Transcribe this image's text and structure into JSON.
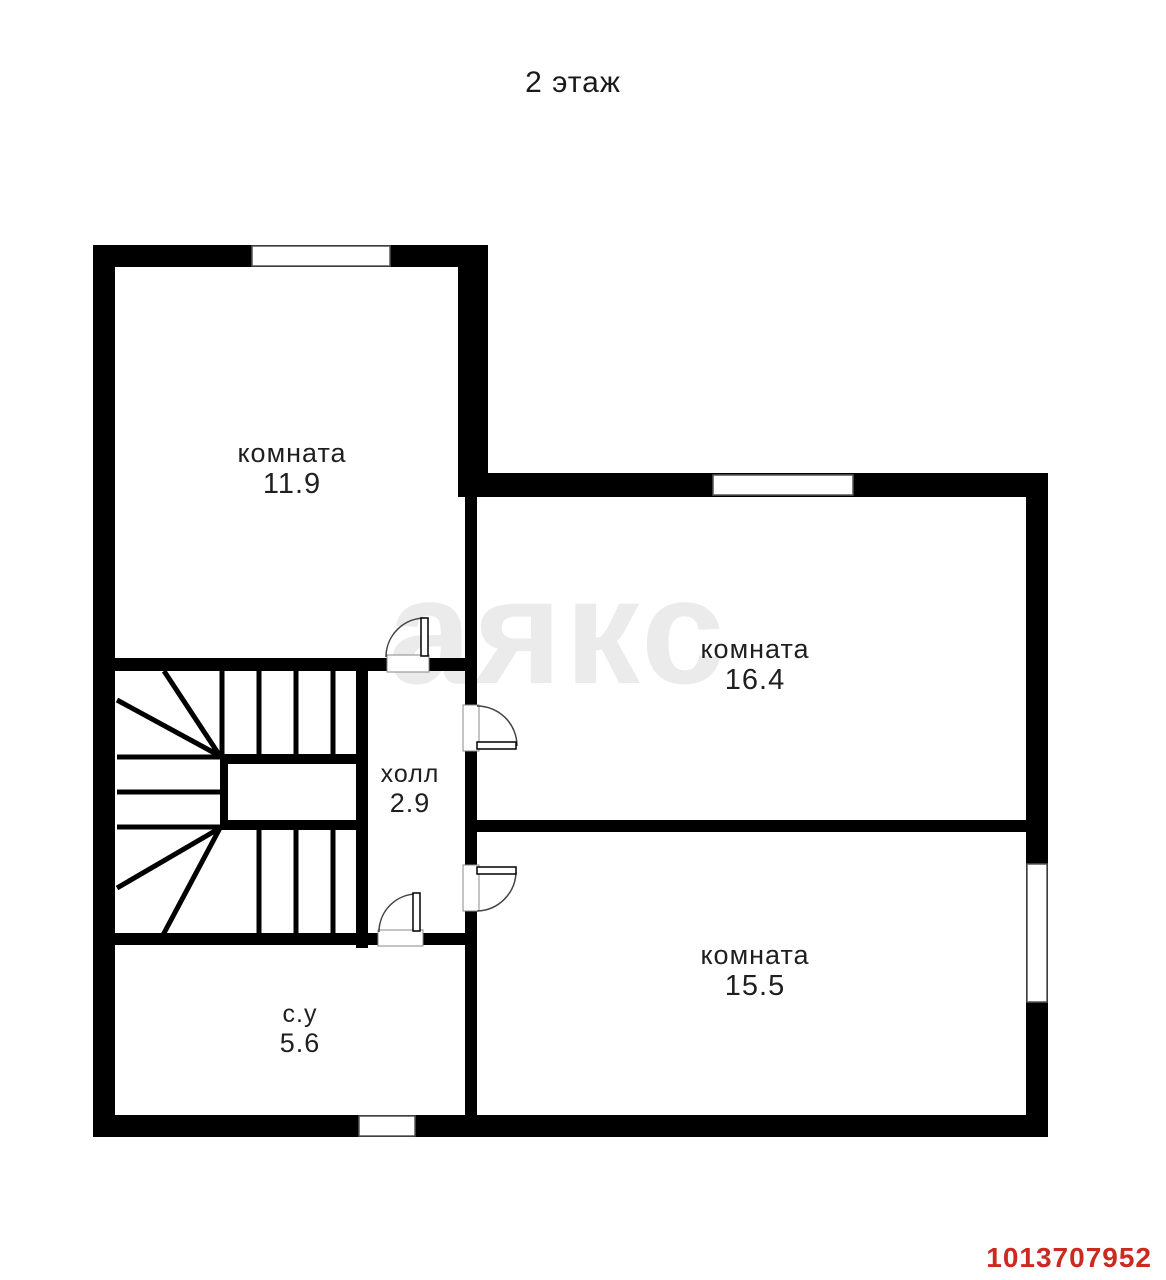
{
  "title": "2 этаж",
  "watermark": {
    "text": "аякс"
  },
  "listing_id": "1013707952",
  "rooms": {
    "room_11_9": {
      "label": "комната",
      "area": "11.9"
    },
    "room_16_4": {
      "label": "комната",
      "area": "16.4"
    },
    "room_15_5": {
      "label": "комната",
      "area": "15.5"
    },
    "hall": {
      "label": "холл",
      "area": "2.9"
    },
    "bathroom": {
      "label": "с.у",
      "area": "5.6"
    }
  },
  "colors": {
    "wall": "#000000",
    "listing_id_text": "#cc2920",
    "watermark_gray": "#ebebeb"
  },
  "features": {
    "windows_count": 4,
    "doors_count": 4,
    "staircase": "U-образная лестница"
  }
}
